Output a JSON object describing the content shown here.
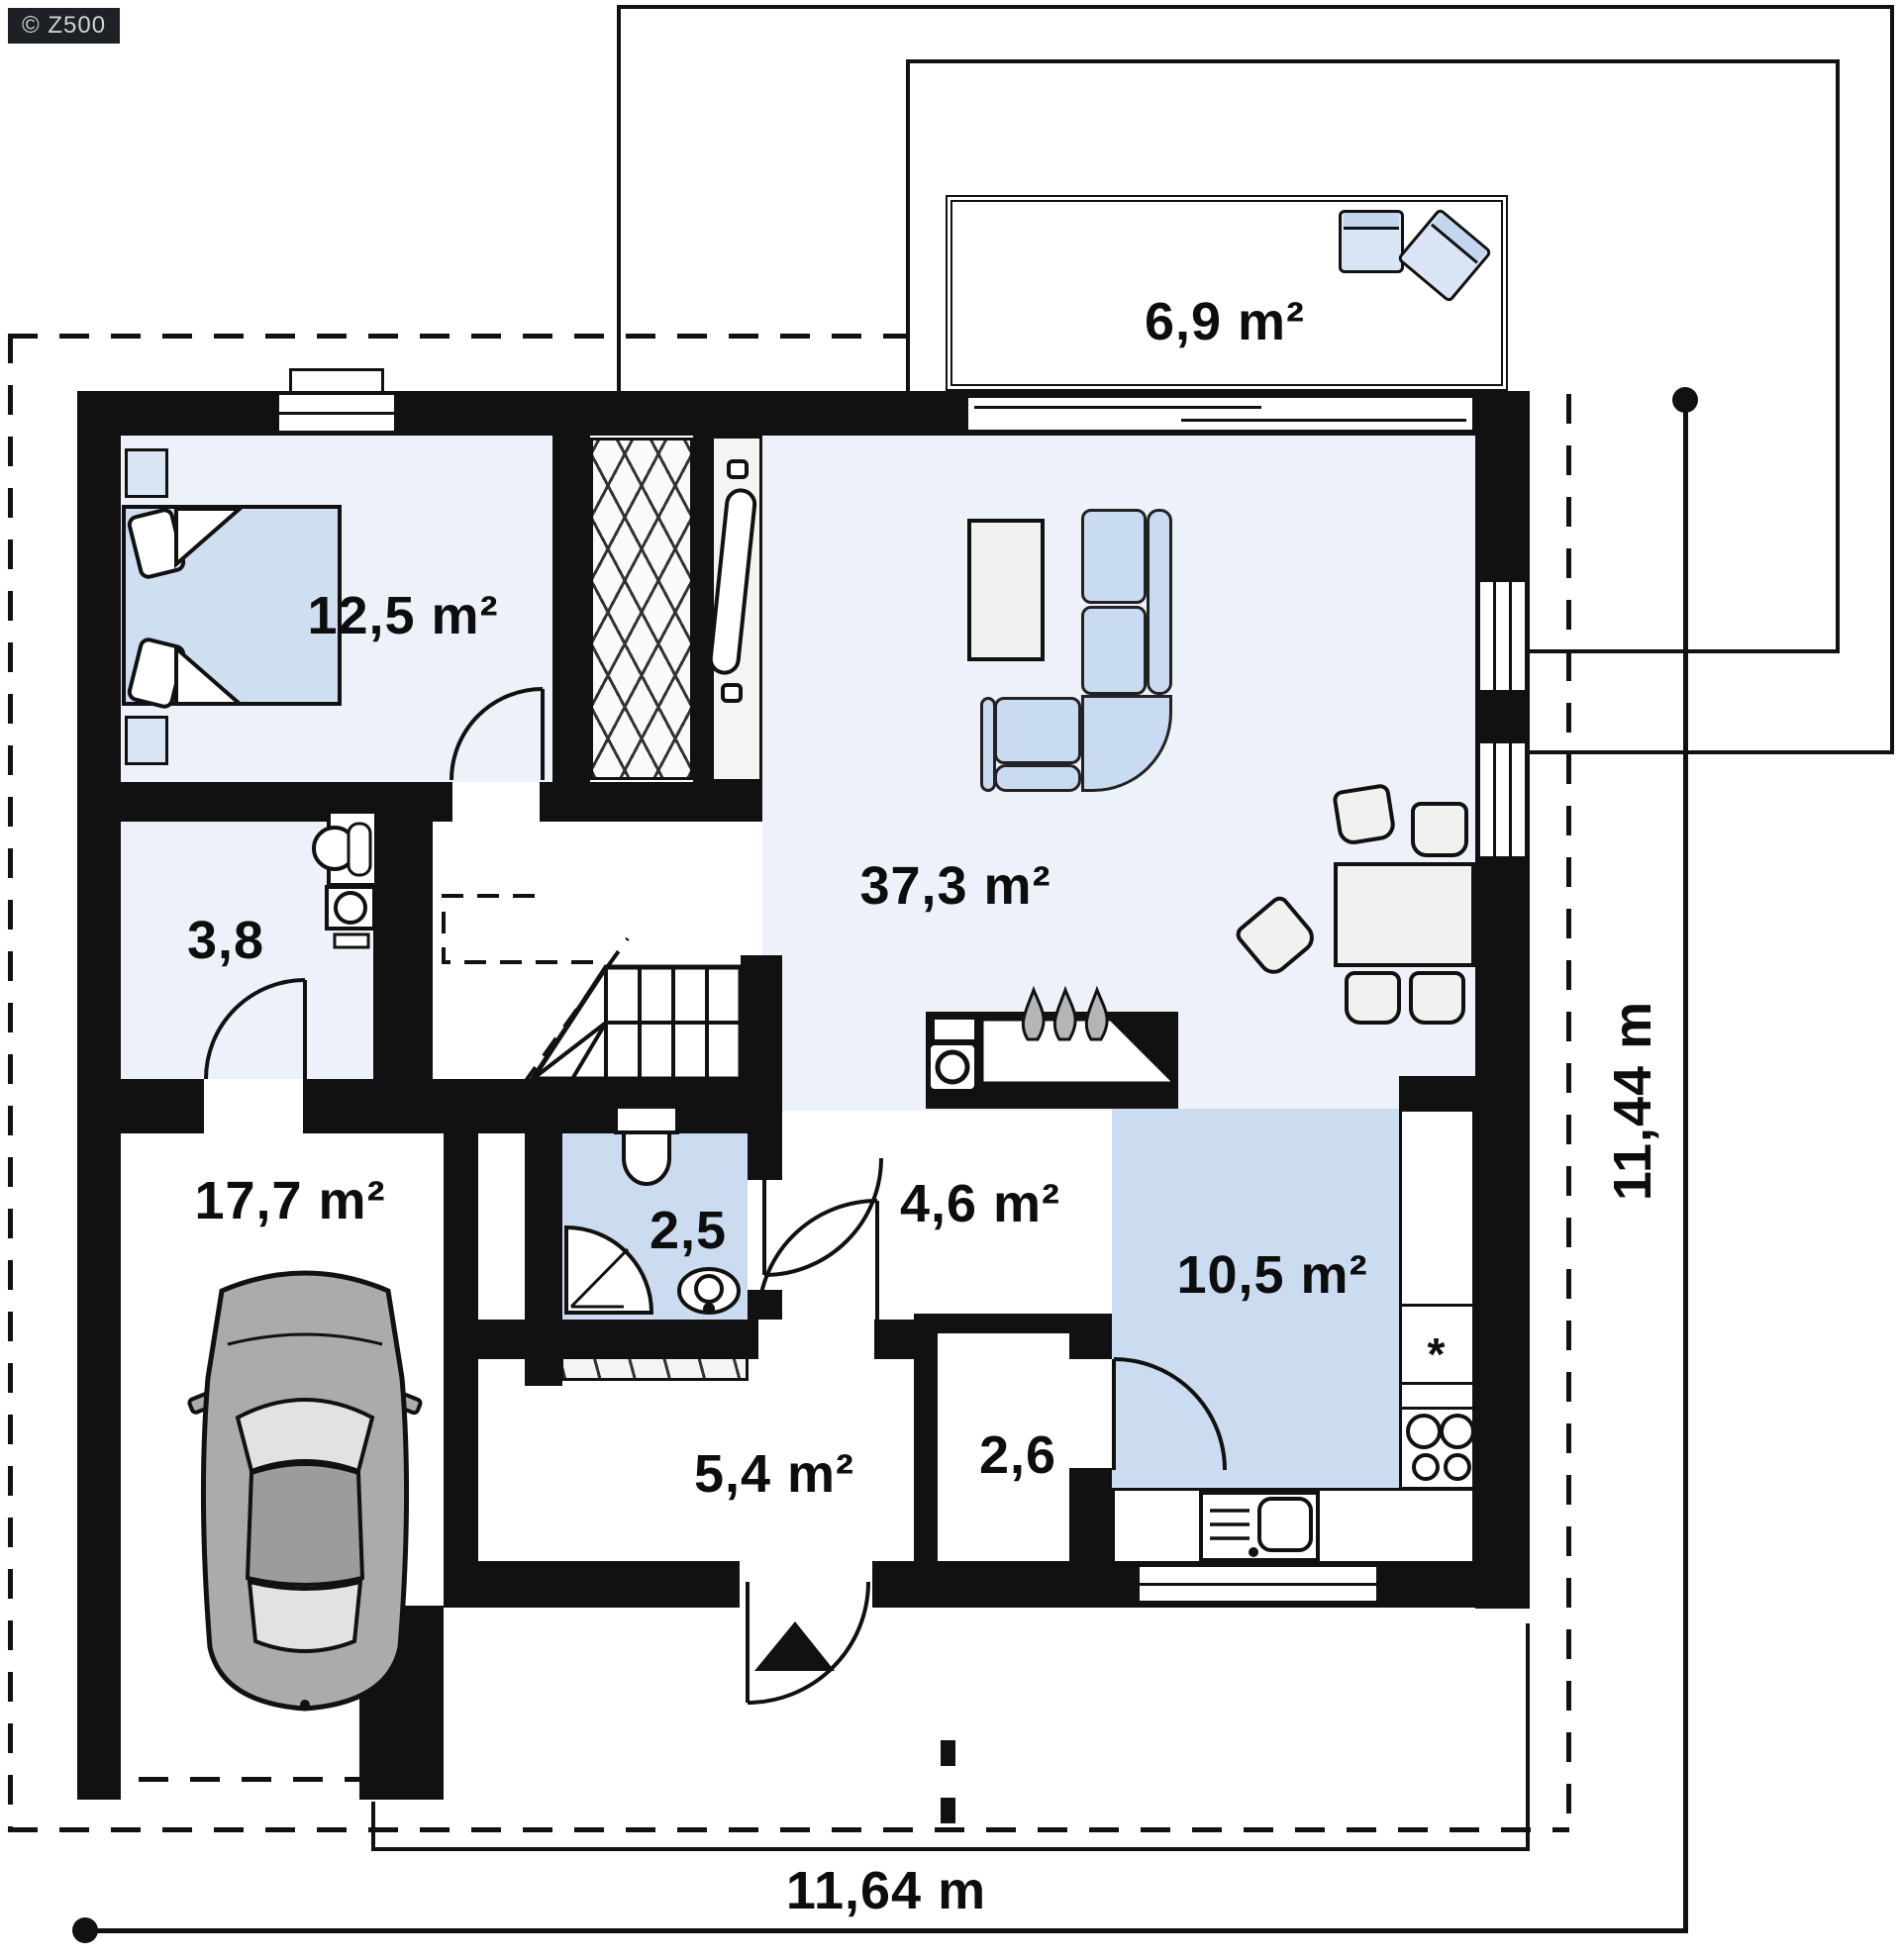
{
  "badge": {
    "label": "© Z500"
  },
  "rooms": [
    {
      "name": "terrace",
      "area_label": "6,9 m²"
    },
    {
      "name": "bedroom",
      "area_label": "12,5 m²"
    },
    {
      "name": "living-room",
      "area_label": "37,3 m²"
    },
    {
      "name": "utility-room",
      "area_label": "3,8"
    },
    {
      "name": "garage",
      "area_label": "17,7 m²"
    },
    {
      "name": "bathroom",
      "area_label": "2,5"
    },
    {
      "name": "hall",
      "area_label": "4,6 m²"
    },
    {
      "name": "kitchen",
      "area_label": "10,5 m²"
    },
    {
      "name": "entry-hall",
      "area_label": "5,4 m²"
    },
    {
      "name": "pantry",
      "area_label": "2,6"
    }
  ],
  "dimensions": {
    "overall_width": "11,64 m",
    "overall_height": "11,44 m"
  },
  "kitchen": {
    "fridge_marker": "*"
  },
  "furniture": [
    "double-bed",
    "nightstand",
    "wardrobe",
    "sideboard",
    "corner-sofa",
    "coffee-table",
    "dining-table",
    "dining-chair",
    "garden-armchair",
    "fireplace",
    "winder-stairs",
    "toilet",
    "shower-cabin",
    "washbasin",
    "boiler",
    "car",
    "kitchen-counter",
    "hob",
    "fridge",
    "kitchen-sink",
    "coat-closet"
  ],
  "colors": {
    "wall": "#111111",
    "floor_light": "#edf2fa",
    "floor_blue": "#ccdcf0",
    "furniture_blue": "#c9dbf1",
    "furniture_gray": "#f1f1ef",
    "car_gray": "#ababab"
  }
}
